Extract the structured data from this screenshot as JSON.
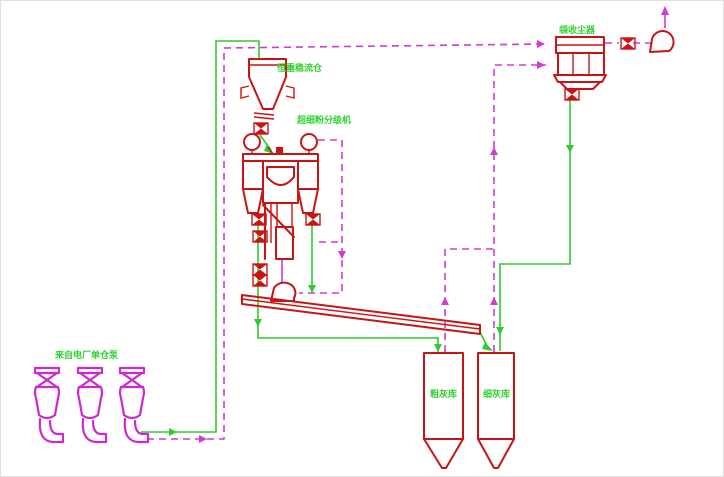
{
  "diagram": {
    "labels": {
      "source_pumps": "来自电厂单仓泵",
      "surge_bin": "恒重稳流仓",
      "classifier": "超细粉分级机",
      "bag_filter": "袋收尘器",
      "coarse_silo": "粗灰库",
      "fine_silo": "细灰库"
    },
    "colors": {
      "equipment": "#c81414",
      "pump_magenta": "#cc2acc",
      "material_line_green": "#2ecc2e",
      "air_line_magenta": "#cf3ccf",
      "label_green": "#2fd32f"
    }
  }
}
